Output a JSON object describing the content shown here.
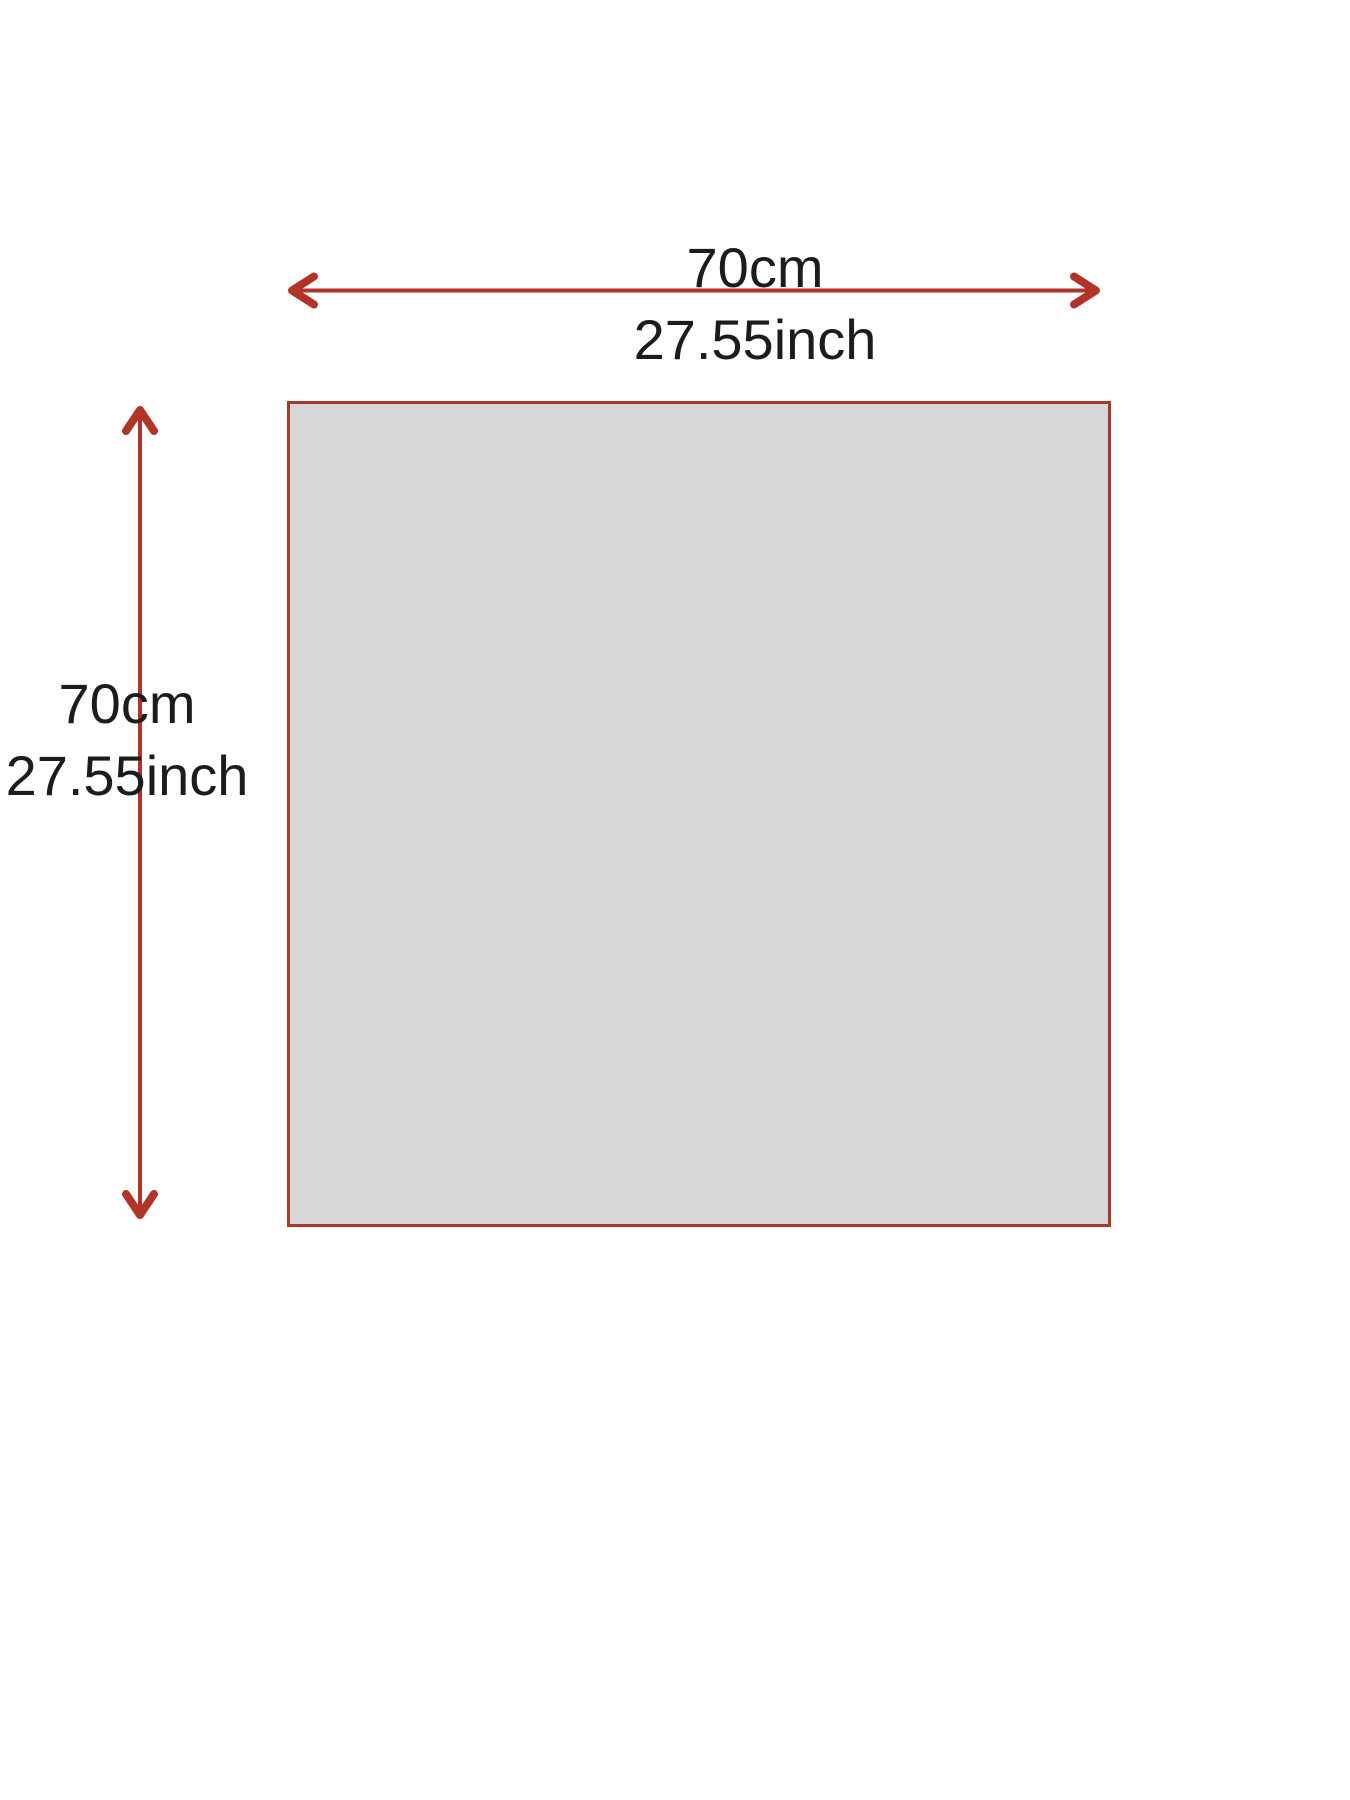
{
  "colors": {
    "background": "#ffffff",
    "square_fill": "#d7d7d7",
    "square_border": "#a53a2b",
    "arrow": "#b23327",
    "text": "#1c1c1c"
  },
  "labels": {
    "width": {
      "cm": "70cm",
      "inch": "27.55inch"
    },
    "height": {
      "cm": "70cm",
      "inch": "27.55inch"
    }
  }
}
